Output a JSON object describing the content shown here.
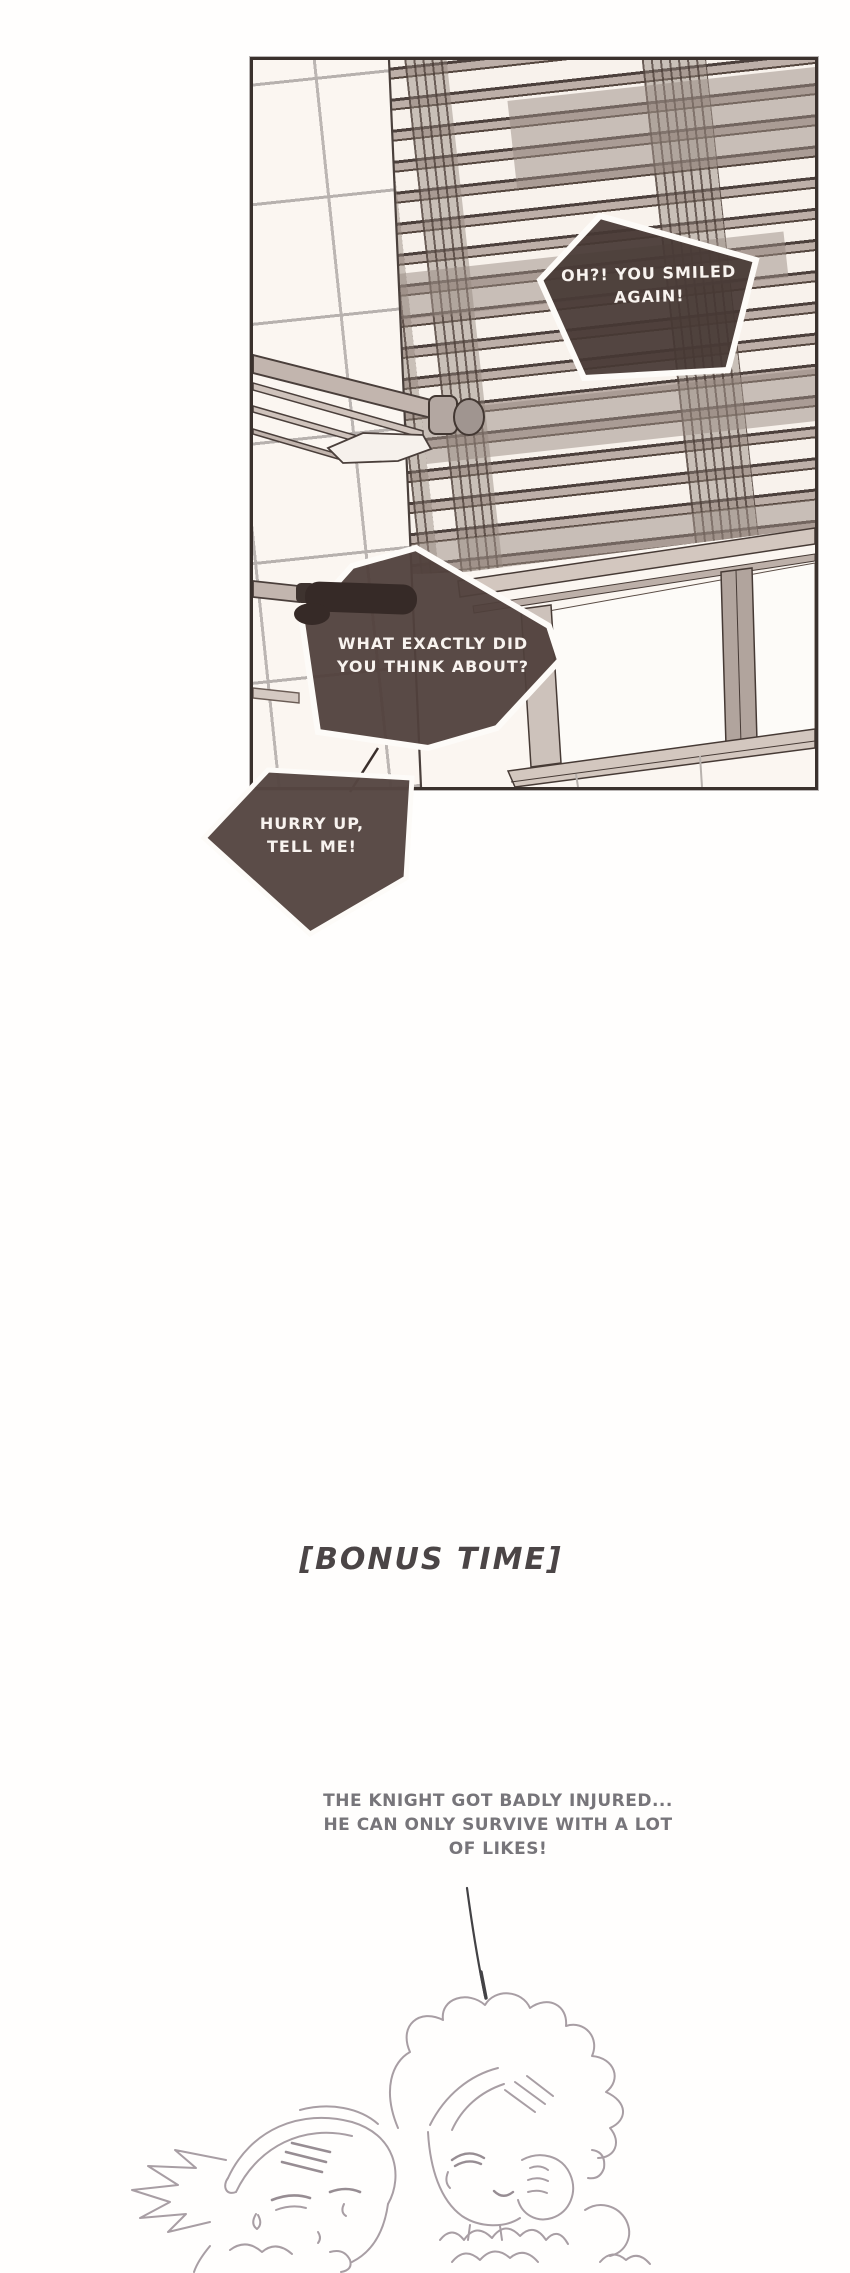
{
  "panel": {
    "bubbles": [
      {
        "id": "bubble-1",
        "text": "OH?! YOU SMILED\nAGAIN!"
      },
      {
        "id": "bubble-2",
        "text": "WHAT EXACTLY DID\nYOU THINK ABOUT?"
      },
      {
        "id": "bubble-3",
        "text": "HURRY UP,\nTELL ME!"
      }
    ]
  },
  "bonus": {
    "title": "[BONUS TIME]",
    "caption": "THE KNIGHT GOT BADLY INJURED...\nHE CAN ONLY SURVIVE WITH A LOT\nOF LIKES!"
  },
  "colors": {
    "bubble_fill": "#4f413e",
    "bubble_border": "#fdfbf8",
    "bubble_text": "#f8f3ef",
    "panel_border": "#3a312d",
    "panel_background": "#fbf6f1",
    "slat_dark": "#4c403c",
    "slat_tan": "#bdafa8",
    "tile_line": "#b7b1ae",
    "bonus_title_color": "#4b4546",
    "caption_color": "#77757a",
    "sketch_stroke": "#a89ea4"
  }
}
